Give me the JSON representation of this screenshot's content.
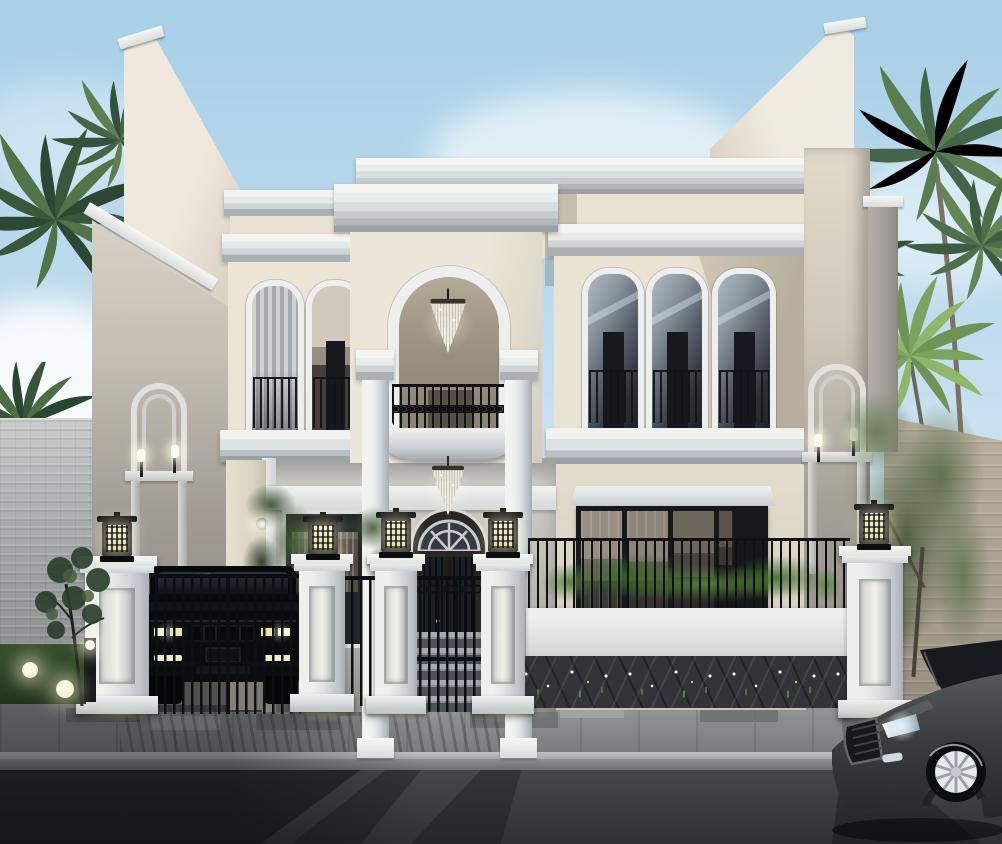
{
  "meta": {
    "kind": "architectural-exterior-render",
    "description": "Two-story cream neoclassical villa at dusk: arched portico with crystal chandeliers, curved iron balcony, arched windows, white fence pillars with glowing lamps, black SUV behind a driveway gate, dark sedan passing on the street, palm trees and boundary walls",
    "width": 1002,
    "height": 844
  },
  "palette": {
    "sky_top": "#a7cfe6",
    "sky_mid": "#c2ddee",
    "sky_low": "#dcebf3",
    "cloud": "#ffffff",
    "cream": "#e9e2d3",
    "cream_hi": "#efe9db",
    "cream_sh": "#cfc7b7",
    "trim": "#f3f4f2",
    "trim_mid": "#dfe2e2",
    "trim_sh": "#b3b8bc",
    "side_wall": "#9b978f",
    "porch": "#c8c6c1",
    "arch_recess": "#9c9181",
    "glass_light": "#8b97a3",
    "glass_dark": "#22262c",
    "metal_black": "#121316",
    "brick_wall": "#b9bdbd",
    "stone_wall": "#b4a998",
    "palm_dark": "#2e4a35",
    "palm_mid": "#4a6b4a",
    "palm_bright": "#7ba05c",
    "tree_olive": "#5f7050",
    "grass": "#2f4526",
    "plant": "#4d7a33",
    "flower_white": "#f3f5ee",
    "flower_yellow": "#f5d76e",
    "lamp_glow": "#f6f2d8",
    "sidewalk": "#8f9092",
    "paver_dark": "#6c6e71",
    "curb": "#b0b1b3",
    "road": "#414246",
    "suv_black": "#0b0c0e",
    "sedan_gray": "#3e3f42",
    "wheel_rim": "#e6eaee"
  },
  "scene": {
    "sky": {
      "label": "clear dusk sky with soft clouds"
    },
    "vegetation": {
      "palms_top_left": "palm crowns, top-left corner",
      "palm_left_mid": "palm crown above left brick wall",
      "palms_top_right": "palm cluster, top-right",
      "tree_right": "leafy tree by right boundary wall",
      "lawn_tree": "small tree on left lawn",
      "bushes": "shrubs inside the front yard"
    },
    "house": {
      "style": "two-story neoclassical villa, cream stucco, white cornices",
      "portico": {
        "arch": "tall arched opening",
        "chandeliers": 2,
        "balcony": "curved black wrought-iron balcony",
        "columns": 2
      },
      "entry": {
        "door": "arched black door with white fanlight",
        "steps": 5
      },
      "left_wing": {
        "upper_arched_windows": 2,
        "niche": "arched niche with 2 sconces",
        "glass_door": "dark-framed glass door in porch"
      },
      "right_wing": {
        "upper_arched_windows": 3,
        "ground_window": "wide black-framed window wall",
        "niche": "arched niche with 2 sconces"
      }
    },
    "fence": {
      "pillars": 5,
      "pillar_lamps": 5,
      "driveway_gate": "black vertical-bar double gate",
      "pedestrian_gate": "black bar gate with scroll top",
      "right_section": "white wall with black railing, plants behind, flower bed in front"
    },
    "vehicles": {
      "suv": "black SUV parked behind the driveway gate",
      "sedan": "dark gray sedan on the street, bottom-right, bright alloy wheel"
    },
    "street": {
      "sidewalk": "gray paver sidewalk with darker accent tiles",
      "road": "asphalt with long evening shadows of gate and pillars",
      "accent_lights": "glowing ball lights and a bollard on the left lawn"
    }
  }
}
